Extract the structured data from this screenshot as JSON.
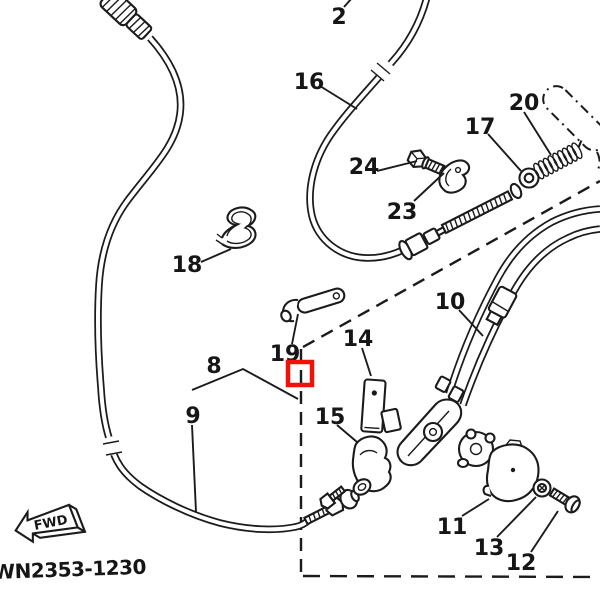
{
  "figure": {
    "footer_code": "WN2353-1230",
    "fwd_label": "FWD",
    "highlight_color": "#ee1208",
    "line_color": "#1b1b1b",
    "background": "#ffffff",
    "callouts": {
      "2": "2",
      "8": "8",
      "9": "9",
      "10": "10",
      "11": "11",
      "12": "12",
      "13": "13",
      "14": "14",
      "15": "15",
      "16": "16",
      "17": "17",
      "18": "18",
      "19": "19",
      "20": "20",
      "23": "23",
      "24": "24"
    }
  }
}
